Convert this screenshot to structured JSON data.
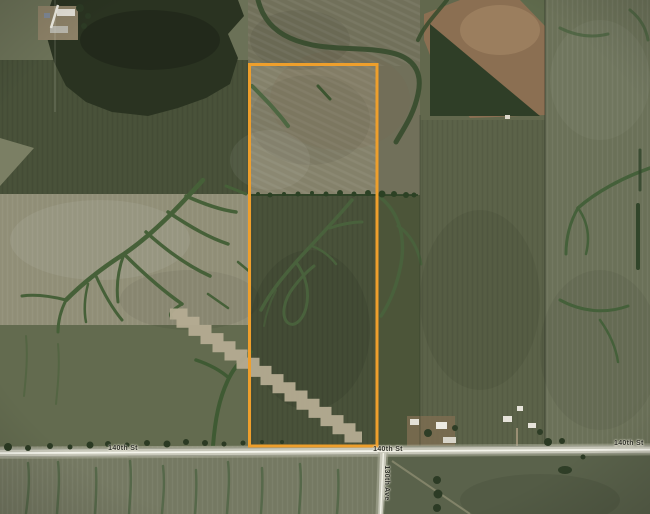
{
  "map": {
    "imagery": "satellite-farmland",
    "parcel": {
      "outline_color": "#EE9F2C"
    },
    "road_labels": [
      {
        "text": "140th St",
        "orientation": "horizontal",
        "position": "west"
      },
      {
        "text": "140th St",
        "orientation": "horizontal",
        "position": "center"
      },
      {
        "text": "140th St",
        "orientation": "horizontal",
        "position": "east"
      },
      {
        "text": "130th Ave",
        "orientation": "vertical",
        "position": "south-of-junction"
      }
    ],
    "label_color": "#2f312a"
  }
}
